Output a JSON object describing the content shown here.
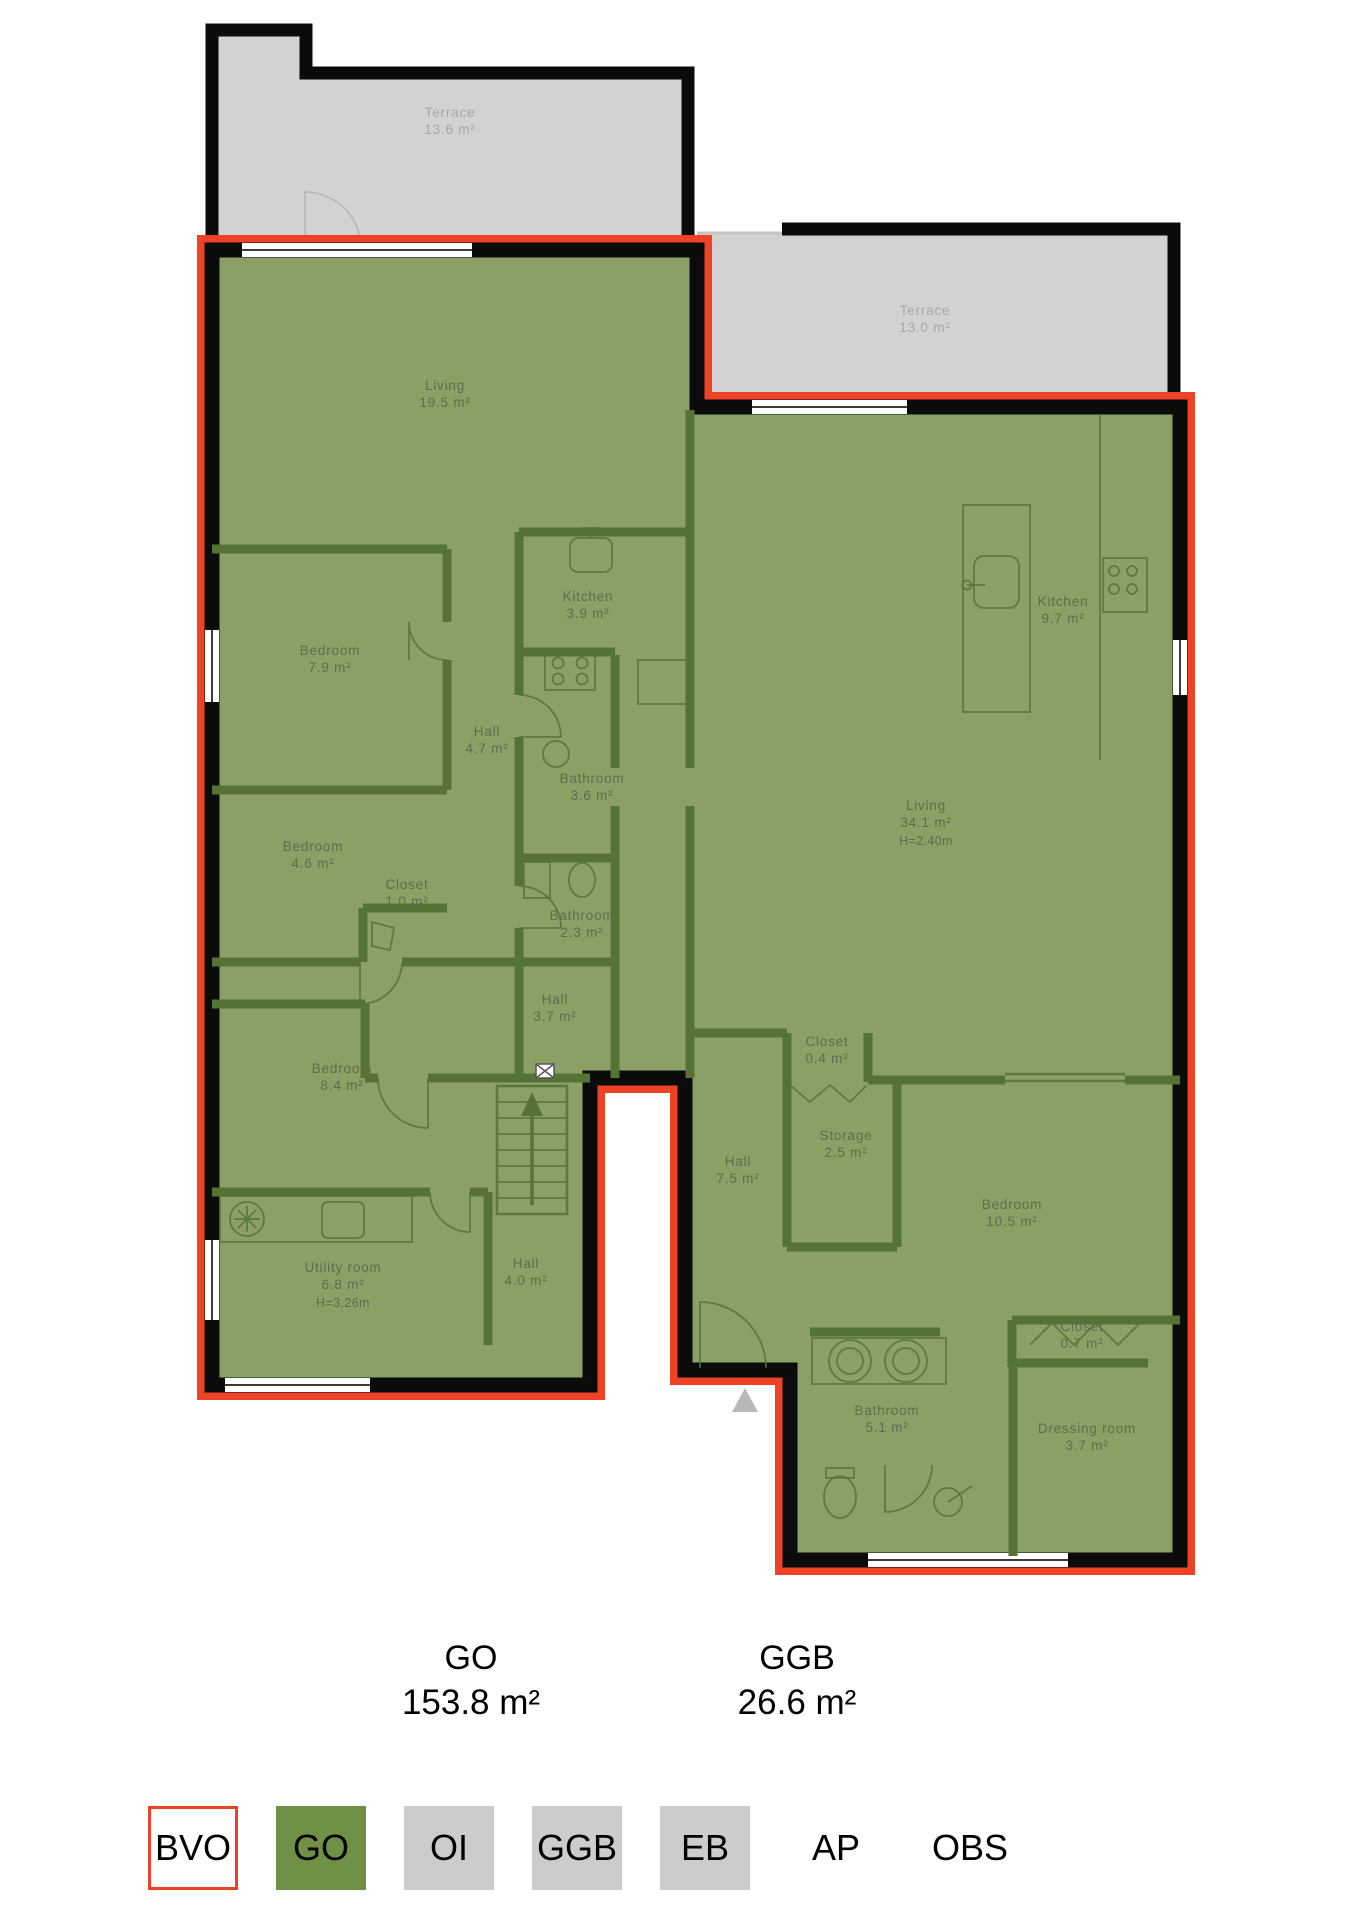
{
  "title": "Apartment floor plan with area overlay",
  "colors": {
    "red": "#ee4224",
    "green": "#8aa065",
    "legendGreen": "#6f9045",
    "terrace": "#d2d2d2",
    "legendGray": "#cccccc",
    "wall": "#0b0b0b",
    "iwall": "#567336"
  },
  "plan": {
    "terraces": [
      {
        "name": "Terrace",
        "area": "13.6 m²",
        "x": 450,
        "y": 112
      },
      {
        "name": "Terrace",
        "area": "13.0 m²",
        "x": 925,
        "y": 310
      }
    ],
    "rooms": [
      {
        "name": "Living",
        "area": "19.5 m²",
        "x": 445,
        "y": 385
      },
      {
        "name": "Kitchen",
        "area": "3.9 m²",
        "x": 588,
        "y": 596
      },
      {
        "name": "Bedroom",
        "area": "7.9 m²",
        "x": 330,
        "y": 650
      },
      {
        "name": "Hall",
        "area": "4.7 m²",
        "x": 487,
        "y": 731
      },
      {
        "name": "Bathroom",
        "area": "3.6 m²",
        "x": 592,
        "y": 778
      },
      {
        "name": "Bedroom",
        "area": "4.6 m²",
        "x": 313,
        "y": 846
      },
      {
        "name": "Closet",
        "area": "1.0 m²",
        "x": 407,
        "y": 884
      },
      {
        "name": "Bathroom",
        "area": "2.3 m²",
        "x": 582,
        "y": 915
      },
      {
        "name": "Hall",
        "area": "3.7 m²",
        "x": 555,
        "y": 999
      },
      {
        "name": "Kitchen",
        "area": "9.7 m²",
        "x": 1063,
        "y": 601
      },
      {
        "name": "Living",
        "area": "34.1 m²",
        "note": "H=2.40m",
        "x": 926,
        "y": 805
      },
      {
        "name": "Closet",
        "area": "0.4 m²",
        "x": 827,
        "y": 1041
      },
      {
        "name": "Storage",
        "area": "2.5 m²",
        "x": 846,
        "y": 1135
      },
      {
        "name": "Hall",
        "area": "7.5 m²",
        "x": 738,
        "y": 1161
      },
      {
        "name": "Bedroom",
        "area": "10.5 m²",
        "x": 1012,
        "y": 1204
      },
      {
        "name": "Bedroom",
        "area": "8.4 m²",
        "x": 342,
        "y": 1068
      },
      {
        "name": "Utility room",
        "area": "6.8 m²",
        "note": "H=3.26m",
        "x": 343,
        "y": 1267
      },
      {
        "name": "Hall",
        "area": "4.0 m²",
        "x": 526,
        "y": 1263
      },
      {
        "name": "Closet",
        "area": "0.7 m²",
        "x": 1082,
        "y": 1326
      },
      {
        "name": "Bathroom",
        "area": "5.1 m²",
        "x": 887,
        "y": 1410
      },
      {
        "name": "Dressing room",
        "area": "3.7 m²",
        "x": 1087,
        "y": 1428
      }
    ],
    "entrance_marker": "triangle-up"
  },
  "summary": {
    "items": [
      {
        "code": "GO",
        "value": "153.8 m²",
        "x": 471
      },
      {
        "code": "GGB",
        "value": "26.6 m²",
        "x": 797
      }
    ]
  },
  "legend": {
    "items": [
      {
        "label": "BVO",
        "style": "bvo"
      },
      {
        "label": "GO",
        "style": "go"
      },
      {
        "label": "OI",
        "style": "gray"
      },
      {
        "label": "GGB",
        "style": "gray"
      },
      {
        "label": "EB",
        "style": "gray"
      },
      {
        "label": "AP",
        "style": "none"
      },
      {
        "label": "OBS",
        "style": "none"
      }
    ]
  }
}
